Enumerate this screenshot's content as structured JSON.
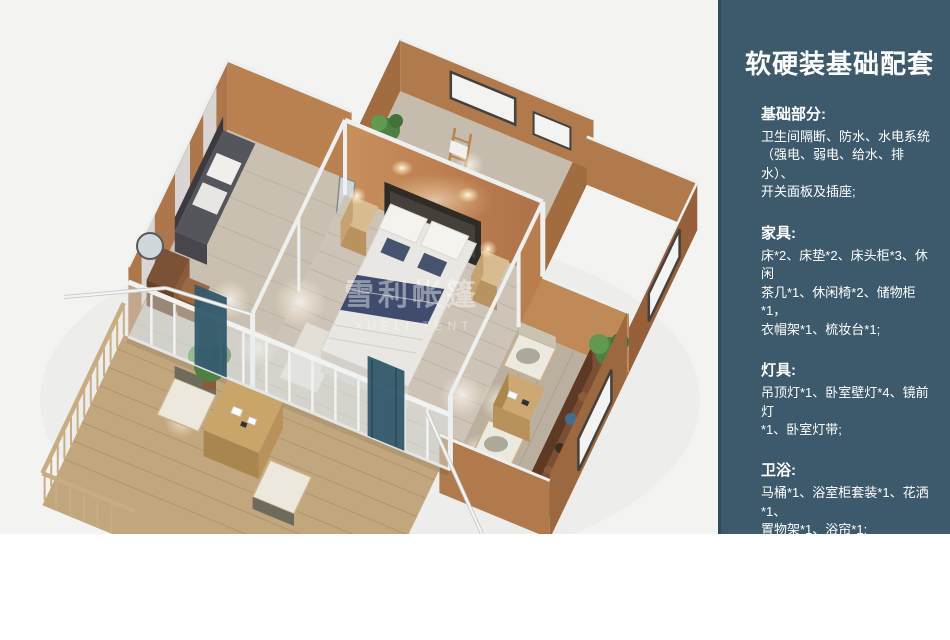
{
  "panel": {
    "title": "软硬装基础配套",
    "sections": [
      {
        "heading": "基础部分:",
        "body": "卫生间隔断、防水、水电系统\n（强电、弱电、给水、排水）、\n开关面板及插座;"
      },
      {
        "heading": "家具:",
        "body": "床*2、床垫*2、床头柜*3、休闲\n茶几*1、休闲椅*2、储物柜*1，\n衣帽架*1、梳妆台*1;"
      },
      {
        "heading": "灯具:",
        "body": "吊顶灯*1、卧室壁灯*4、镜前灯\n*1、卧室灯带;"
      },
      {
        "heading": "卫浴:",
        "body": "马桶*1、浴室柜套装*1、花洒*1、\n置物架*1、浴帘*1;"
      },
      {
        "heading": "地面:",
        "body": "强化木地板、卫生间防滑防潮石\n塑板;"
      }
    ],
    "background": "#3C5A6B",
    "border_color": "#2E4A59",
    "text_color": "#FFFFFF"
  },
  "illustration": {
    "watermark_cn": "雪利帐篷",
    "watermark_en": "XUELI TENT",
    "background": "#F3F3F2",
    "wall_orange": "#BB7D4F",
    "wall_orange_dark": "#A06C40",
    "frame_white": "#EFF1F1",
    "floor_wood": "#CDC4B7",
    "deck_wood": "#C2A77E",
    "curtain_teal": "#31596A",
    "bedding_navy": "#3F4C6E",
    "plant_green": "#4E8044"
  }
}
